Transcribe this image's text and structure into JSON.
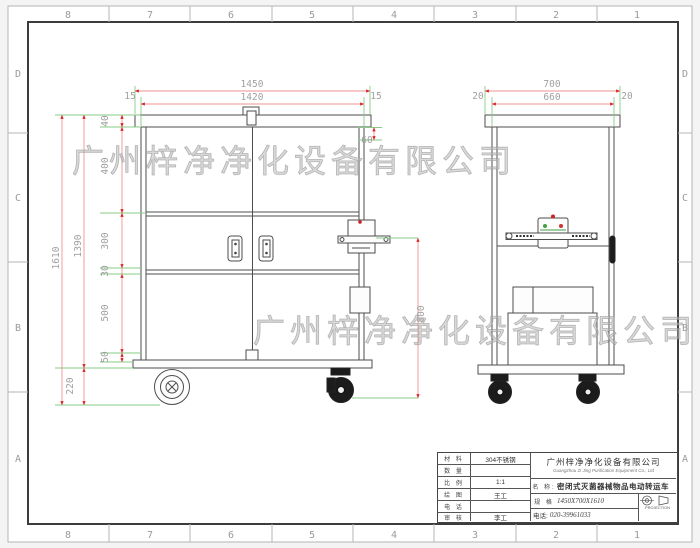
{
  "sheet": {
    "zones_top": [
      "8",
      "7",
      "6",
      "5",
      "4",
      "3",
      "2",
      "1"
    ],
    "zones_bottom": [
      "8",
      "7",
      "6",
      "5",
      "4",
      "3",
      "2",
      "1"
    ],
    "zones_left": [
      "D",
      "C",
      "B",
      "A"
    ],
    "zones_right": [
      "D",
      "C",
      "B",
      "A"
    ]
  },
  "watermark": {
    "line1": "广州梓净净化设备有限公司",
    "line2": "广州梓净净化设备有限公司"
  },
  "dims": {
    "front": {
      "overall_w": "1450",
      "inner_w": "1420",
      "off_l": "15",
      "off_r": "15",
      "lid": "60",
      "total_h": "1610",
      "body_h": "1390",
      "s40": "40",
      "s400": "400",
      "s300": "300",
      "s30": "30",
      "s500": "500",
      "s50": "50",
      "wheel": "220",
      "right_h": "800"
    },
    "side": {
      "overall_w": "700",
      "inner_w": "660",
      "off_l": "20",
      "off_r": "20"
    }
  },
  "title_block": {
    "rows": [
      {
        "label": "材 料",
        "value": "304不锈钢"
      },
      {
        "label": "数 量",
        "value": ""
      },
      {
        "label": "比 例",
        "value": "1:1"
      },
      {
        "label": "绘 图",
        "value": "王工"
      },
      {
        "label": "电 话",
        "value": ""
      },
      {
        "label": "审 核",
        "value": "李工"
      }
    ],
    "company_cn": "广州梓净净化设备有限公司",
    "company_en": "Guangzhou Zi Jing Purification Equipment Co., Ltd",
    "name_label": "名 称:",
    "name_value": "密闭式灭菌器械物品电动转运车",
    "spec_label": "规 格",
    "spec_value": "1450X700X1610",
    "phone_label": "电话:",
    "phone_value": "020-39961033",
    "projection": "PROJECTION"
  }
}
